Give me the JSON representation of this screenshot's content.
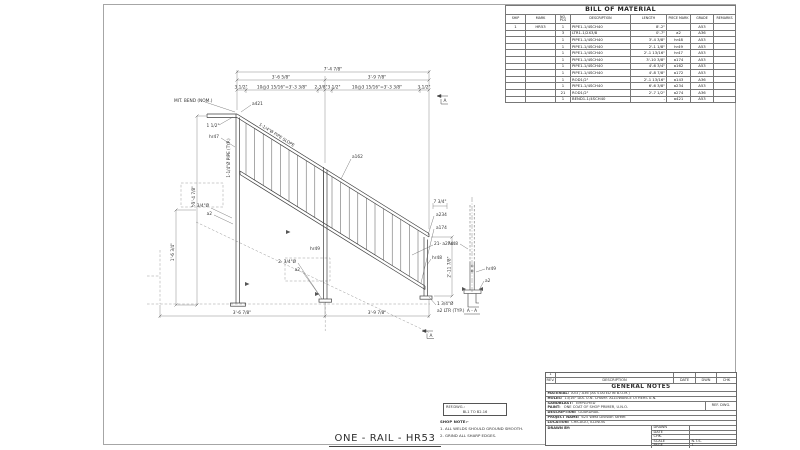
{
  "sheet": {
    "title": "ONE - RAIL - HR53"
  },
  "bom": {
    "title": "BILL OF MATERIAL",
    "headers": [
      "SHIP",
      "MARK",
      "NO. PCS",
      "DESCRIPTION",
      "LENGTH",
      "PIECE MARK",
      "GRADE",
      "REMARKS"
    ],
    "rows": [
      [
        "1",
        "HR53",
        "1",
        "PIPE1-1/4SCH40",
        "8'-2\"",
        "",
        "A53",
        ""
      ],
      [
        "",
        "",
        "3",
        "LTR1-1/2X3/8",
        "0'-7\"",
        "a2",
        "A36",
        ""
      ],
      [
        "",
        "",
        "1",
        "PIPE1-1/4SCH40",
        "3'-4 3/8\"",
        "hr48",
        "A53",
        ""
      ],
      [
        "",
        "",
        "1",
        "PIPE1-1/4SCH40",
        "2'-1 1/8\"",
        "hr49",
        "A53",
        ""
      ],
      [
        "",
        "",
        "1",
        "PIPE1-1/4SCH40",
        "2'-1 13/16\"",
        "hr47",
        "A53",
        ""
      ],
      [
        "",
        "",
        "1",
        "PIPE1-1/4SCH40",
        "3'-10 3/8\"",
        "a174",
        "A53",
        ""
      ],
      [
        "",
        "",
        "1",
        "PIPE1-1/4SCH40",
        "4'-6 3/4\"",
        "a162",
        "A53",
        ""
      ],
      [
        "",
        "",
        "1",
        "PIPE1-1/4SCH40",
        "4'-8 7/8\"",
        "a172",
        "A53",
        ""
      ],
      [
        "",
        "",
        "1",
        "ROD1/2\"",
        "2'-1 13/16\"",
        "a143",
        "A36",
        ""
      ],
      [
        "",
        "",
        "1",
        "PIPE1-1/4SCH40",
        "6'-6 3/8\"",
        "a234",
        "A53",
        ""
      ],
      [
        "",
        "",
        "21",
        "ROD1/2\"",
        "2'-7 1/2\"",
        "a274",
        "A36",
        ""
      ],
      [
        "",
        "",
        "1",
        "BEND1-1/4SCH40",
        "-",
        "a421",
        "A53",
        ""
      ]
    ]
  },
  "titleblock": {
    "rev_no": "1",
    "rev_headers": [
      "REV.",
      "DESCRIPTION",
      "DATE",
      "DWN",
      "CHK"
    ],
    "general_notes": "GENERAL NOTES",
    "material_label": "MATERIAL:",
    "material_value": "A53 / A36 (AS STATED IN B.O.M.)",
    "holes_label": "HOLES:",
    "holes_value": "13/16\" DIA. U.N.   CHAMF.   ALLOWANCE   OTHERS U.N.",
    "blast_label": "SANDBLAST:",
    "blast_value": "EMPLOYED",
    "paint_label": "PAINT:",
    "paint_value": "ONE COAT OF SHOP PRIMER, U.N.O.",
    "refdwg_label": "REF. DWG.",
    "desc_label": "DESCRIPTION:",
    "desc_value": "GUARDRAIL",
    "project_label": "PROJECT NAME:",
    "project_value": "625 West Division Street",
    "location_label": "LOCATION:",
    "location_value": "CHICAGO, ILLINOIS",
    "drawnby_label": "DRAWN BY:",
    "grid": [
      {
        "label": "DRAWN",
        "value": ""
      },
      {
        "label": "DATE",
        "value": ""
      },
      {
        "label": "CHK.",
        "value": ""
      },
      {
        "label": "SCALE",
        "value": "N.T.S."
      },
      {
        "label": "PAGE",
        "value": "1"
      }
    ]
  },
  "shopnote": {
    "ref_label": "REF.DWG.:",
    "ref_value": "BL1 TO B2.16",
    "title": "SHOP NOTE:-",
    "notes": [
      "1. ALL WELDS SHOULD GROUND SMOOTH.",
      "2. GRIND ALL SHARP EDGES."
    ]
  },
  "drawing": {
    "picket_count": 21,
    "labels": {
      "dim_overall_top": "7'-4 7/8\"",
      "dim_top_left": "3'-6 5/8\"",
      "dim_top_right": "3'-9 7/8\"",
      "dim_end_left": "3 1/2\"",
      "dim_spacing_left": "10@3 15/16\"=3'-3 3/8\"",
      "dim_mid_a": "2 3/8\"",
      "dim_mid_b": "3 1/2\"",
      "dim_spacing_right": "10@3 15/16\"=3'-3 3/8\"",
      "dim_end_right": "3 1/2\"",
      "note_miter": "MIT. BEND (NOM.)",
      "dim_bend_offset": "1 1/2\"",
      "label_slope_pipe": "1-1/4\"Ø PIPE SLOPE",
      "label_post_pipe": "1-1/4\"Ø PIPE (TYP.)",
      "dim_left_height": "3'-4 7/8\"",
      "dim_left_lower": "1'-6 3/4\"",
      "dim_bottom_left": "3'-6 7/8\"",
      "dim_bottom_right": "3'-9 7/8\"",
      "dim_rail_end": "7 3/4\"",
      "dim_post_height": "2'-11 7/8\"",
      "callout_a421": "a421",
      "callout_hr47": "hr47",
      "callout_a162": "a162",
      "callout_a234": "a234",
      "callout_a174": "a174",
      "callout_rods": "21- a274",
      "callout_hr48": "hr48",
      "callout_hr49": "hr49",
      "callout_left_holes": "2- 3/4\"Ø",
      "callout_left_plate": "a2",
      "callout_mid_holes": "2- 3/4\"Ø",
      "callout_mid_plate": "a2",
      "callout_base_hole": "1 3/4\"Ø",
      "callout_base_note": "a2 LTR (TYP.)",
      "section_marker_top": "A",
      "section_marker_bottom": "A",
      "section_title": "A - A",
      "detail_hr48": "hr48",
      "detail_hr49": "hr49",
      "detail_a2": "a2"
    }
  }
}
